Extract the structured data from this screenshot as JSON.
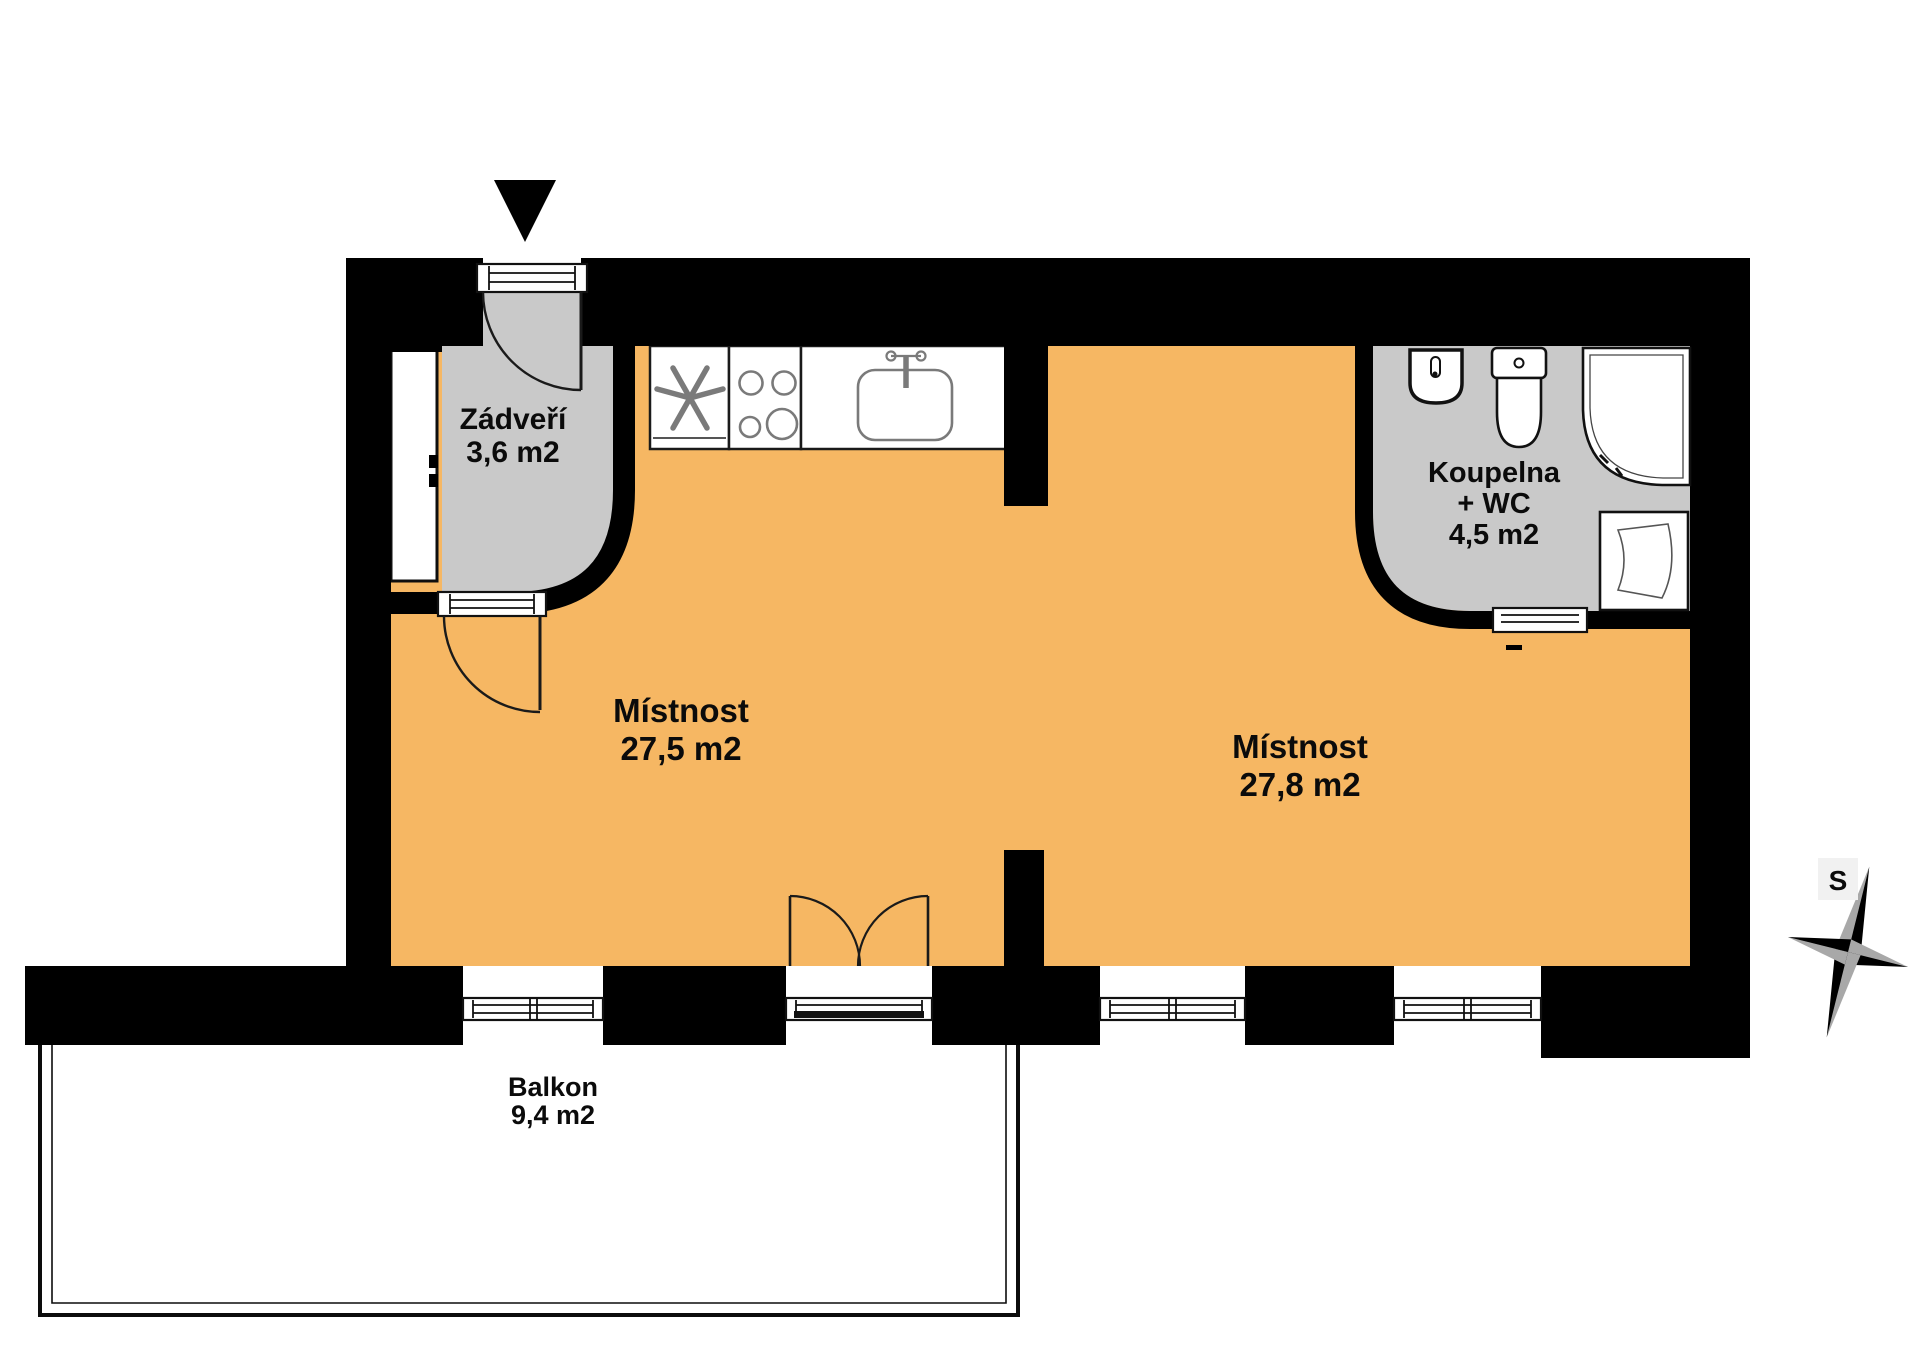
{
  "plan": {
    "type": "apartment-floor-plan",
    "entrance_marker_icon": "entrance-arrow-icon",
    "compass": {
      "label": "S",
      "icon": "compass-rose-icon"
    }
  },
  "rooms": [
    {
      "id": "zadveri",
      "name": "Zádveří",
      "area": "3,6 m2"
    },
    {
      "id": "mistnost-left",
      "name": "Místnost",
      "area": "27,5 m2"
    },
    {
      "id": "mistnost-right",
      "name": "Místnost",
      "area": "27,8 m2"
    },
    {
      "id": "koupelna",
      "name": "Koupelna",
      "line2": "+ WC",
      "area": "4,5 m2"
    },
    {
      "id": "balkon",
      "name": "Balkon",
      "area": "9,4 m2"
    }
  ],
  "fixtures": [
    "extractor-fan-icon",
    "stove-hob-icon",
    "kitchen-sink-icon",
    "wardrobe-icon",
    "washbasin-icon",
    "toilet-icon",
    "corner-shower-icon",
    "washing-machine-icon",
    "window-icon",
    "door-swing-icon",
    "sliding-door-icon"
  ],
  "colors": {
    "wall": "#000000",
    "floor_main": "#F6B763",
    "floor_utility": "#C9C9C9",
    "balcony": "#FFFFFF",
    "fixture_stroke": "#7A7A7A",
    "compass_gray": "#A8A8A8"
  }
}
